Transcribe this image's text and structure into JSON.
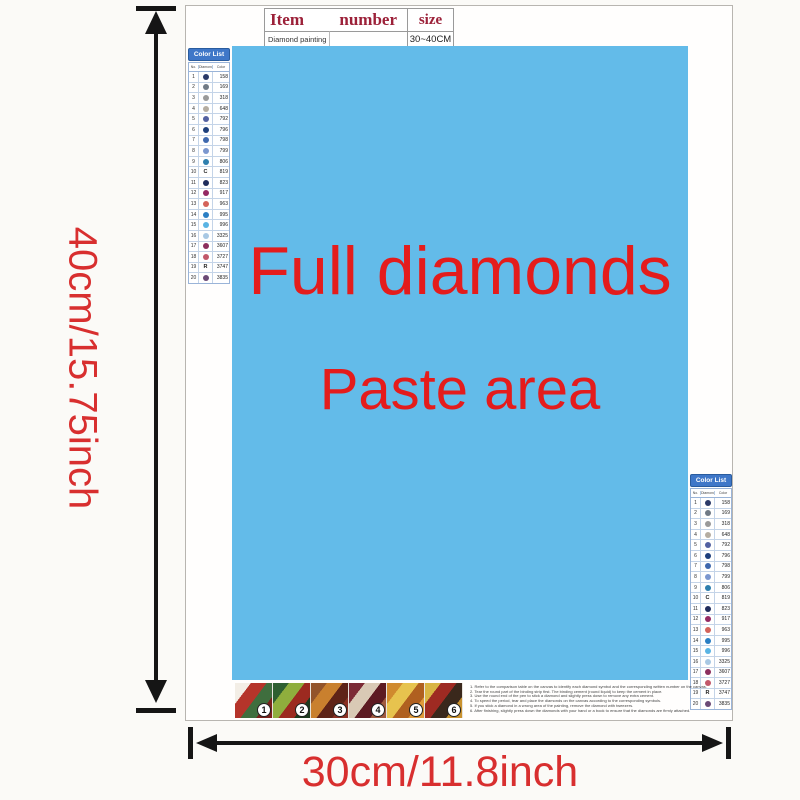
{
  "dimensions": {
    "height_label": "40cm/15.75inch",
    "width_label": "30cm/11.8inch"
  },
  "item_table": {
    "header": {
      "item": "Item",
      "number": "number",
      "size": "size"
    },
    "row": {
      "name": "Diamond painting",
      "size": "30~40CM"
    }
  },
  "paste_area": {
    "line1": "Full diamonds",
    "line2": "Paste area",
    "bg_color": "#63bbe9",
    "text_color": "#e41c1c"
  },
  "color_list": {
    "title": "Color List",
    "columns": [
      "No.",
      "Diamond",
      "Color"
    ],
    "rows": [
      {
        "no": "1",
        "symbol": "dot",
        "color": "#2b3a68",
        "code": "158"
      },
      {
        "no": "2",
        "symbol": "dot",
        "color": "#707a85",
        "code": "169"
      },
      {
        "no": "3",
        "symbol": "dot",
        "color": "#9a9a9a",
        "code": "318"
      },
      {
        "no": "4",
        "symbol": "dot",
        "color": "#b5ada1",
        "code": "648"
      },
      {
        "no": "5",
        "symbol": "dot",
        "color": "#5361a2",
        "code": "792"
      },
      {
        "no": "6",
        "symbol": "dot",
        "color": "#1d3f7c",
        "code": "796"
      },
      {
        "no": "7",
        "symbol": "dot",
        "color": "#3f68ae",
        "code": "798"
      },
      {
        "no": "8",
        "symbol": "dot",
        "color": "#7b97cf",
        "code": "799"
      },
      {
        "no": "9",
        "symbol": "dot",
        "color": "#2e7fae",
        "code": "806"
      },
      {
        "no": "10",
        "symbol": "C",
        "color": "",
        "code": "819"
      },
      {
        "no": "11",
        "symbol": "dot",
        "color": "#1f2c5c",
        "code": "823"
      },
      {
        "no": "12",
        "symbol": "dot",
        "color": "#942963",
        "code": "917"
      },
      {
        "no": "13",
        "symbol": "dot",
        "color": "#d4635a",
        "code": "963"
      },
      {
        "no": "14",
        "symbol": "dot",
        "color": "#2b7fc4",
        "code": "995"
      },
      {
        "no": "15",
        "symbol": "dot",
        "color": "#5ab4e4",
        "code": "996"
      },
      {
        "no": "16",
        "symbol": "dot",
        "color": "#a8c8e4",
        "code": "3325"
      },
      {
        "no": "17",
        "symbol": "dot",
        "color": "#8c2f5e",
        "code": "3607"
      },
      {
        "no": "18",
        "symbol": "dot",
        "color": "#c2586a",
        "code": "3727"
      },
      {
        "no": "19",
        "symbol": "R",
        "color": "",
        "code": "3747"
      },
      {
        "no": "20",
        "symbol": "dot",
        "color": "#6b4a76",
        "code": "3835"
      }
    ]
  },
  "thumbnails": {
    "items": [
      {
        "label": "1",
        "colors": [
          "#f3eee6",
          "#b5342a",
          "#3f6e3e",
          "#7a1f1a"
        ]
      },
      {
        "label": "2",
        "colors": [
          "#2f5f30",
          "#8fae3d",
          "#9c2a20",
          "#1d3a1e"
        ]
      },
      {
        "label": "3",
        "colors": [
          "#93542a",
          "#c9802e",
          "#5e2317",
          "#8a2f22"
        ]
      },
      {
        "label": "4",
        "colors": [
          "#7c2a35",
          "#d9c9b5",
          "#5d1a22",
          "#a05a40"
        ]
      },
      {
        "label": "5",
        "colors": [
          "#d08a2e",
          "#e7c34e",
          "#b06020",
          "#e09a3a"
        ]
      },
      {
        "label": "6",
        "colors": [
          "#d9b544",
          "#9e2a22",
          "#3a281c",
          "#c9922e"
        ]
      }
    ]
  },
  "instructions": {
    "lines": [
      "1. Refer to the comparison table on the canvas to identify each diamond symbol and the corresponding written number on the canvas.",
      "2. Tear the round part of the binding strip first. The binding cement (round liquid) to keep the cement in place.",
      "3. Use the round end of the pen to stick a diamond and slightly press down to remove any extra cement.",
      "4. To speed the period, tear and place the diamonds on the canvas according to the corresponding symbols.",
      "5. If you stick a diamond in a wrong area of the painting, remove the diamond with tweezers.",
      "6. After finishing, slightly press down the diamonds with your hand or a book to ensure that the diamonds are firmly attached."
    ]
  }
}
